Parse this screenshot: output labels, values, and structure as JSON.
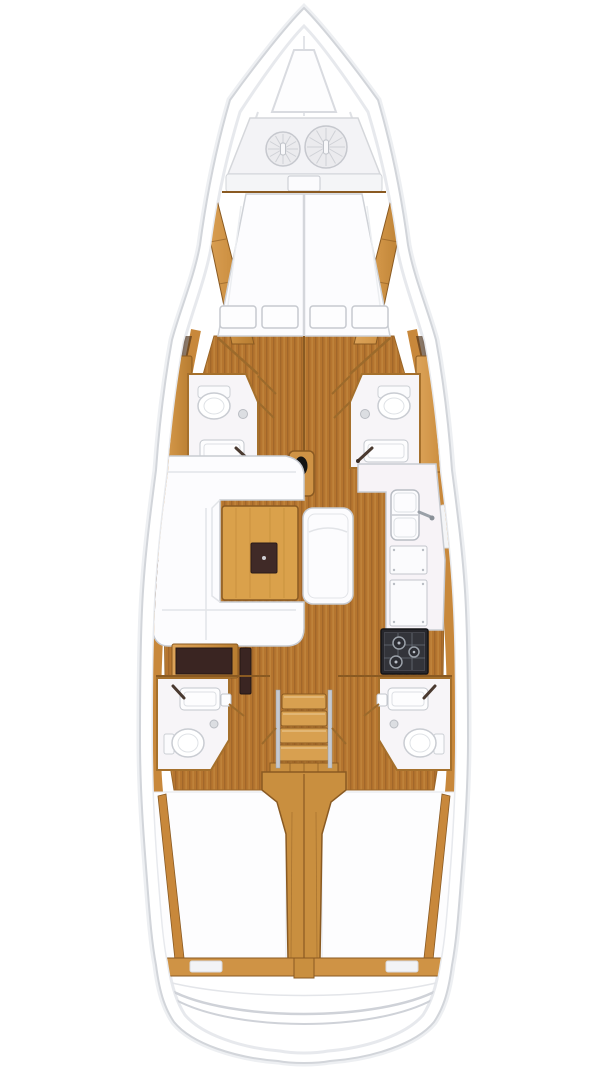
{
  "canvas": {
    "width": 608,
    "height": 1080,
    "background": "#ffffff"
  },
  "diagram": {
    "kind": "sailboat-interior-floor-plan",
    "view": "top-down, bow at top",
    "palette": {
      "hull_white": "#ffffff",
      "outline_gray": "#d2d5da",
      "deck_shadow": "#edeff2",
      "teak": "#b5752f",
      "teak_stripe": "#a2672a",
      "teak_light": "#c68c42",
      "trim_wood": "#cf9345",
      "trim_wood_deep": "#c8883b",
      "wood_edge": "#8a5a22",
      "table_wood": "#daa14b",
      "steps_wood": "#d8a050",
      "column_wood": "#c98f3f",
      "white_furniture": "#fcfcfe",
      "furniture_line": "#c8cbd1",
      "bath_white": "#f7f5f8",
      "bath_wall": "#a5702c",
      "dark_desk": "#3a2522",
      "tray_dark": "#402a27",
      "stove_dark": "#27272c",
      "stove_grate": "#9aa0a8",
      "metal": "#c6c9cf"
    },
    "areas": {
      "bow": {
        "features": [
          "foredeck-hatch",
          "anchor-locker",
          "rope-coil-port",
          "rope-coil-starboard",
          "locker-bulkhead",
          "bulkhead-hatch"
        ]
      },
      "forward_cabin": {
        "features": [
          "v-berth-double",
          "pillows-x4",
          "side-shelf-port",
          "side-shelf-starboard"
        ]
      },
      "forward_heads": {
        "port": [
          "toilet",
          "shower-drain",
          "sink",
          "faucet",
          "door"
        ],
        "starboard": [
          "toilet",
          "shower-drain",
          "sink",
          "faucet",
          "door"
        ]
      },
      "salon": {
        "features": [
          "u-settee-port",
          "dining-table",
          "serving-tray",
          "island-bench",
          "mast-step"
        ]
      },
      "galley": {
        "features": [
          "double-sink",
          "faucet",
          "counter-locker-top",
          "counter-locker-bottom",
          "stove-3-burner"
        ]
      },
      "nav_station": {
        "features": [
          "chart-desk",
          "instrument-panel"
        ]
      },
      "companionway": {
        "features": [
          "steps-x4",
          "handrail-port",
          "handrail-starboard",
          "landing"
        ]
      },
      "aft_heads": {
        "port": [
          "sink",
          "faucet",
          "toilet",
          "shower-drain",
          "door"
        ],
        "starboard": [
          "sink",
          "faucet",
          "toilet",
          "shower-drain",
          "door"
        ]
      },
      "aft_cabins": {
        "features": [
          "berth-port",
          "berth-starboard",
          "engine-compartment-column",
          "hull-stringer-port",
          "hull-stringer-starboard"
        ]
      },
      "stern": {
        "features": [
          "transom-beam",
          "beam-slot-port",
          "beam-slot-starboard",
          "transom-seat-curves"
        ]
      }
    }
  }
}
